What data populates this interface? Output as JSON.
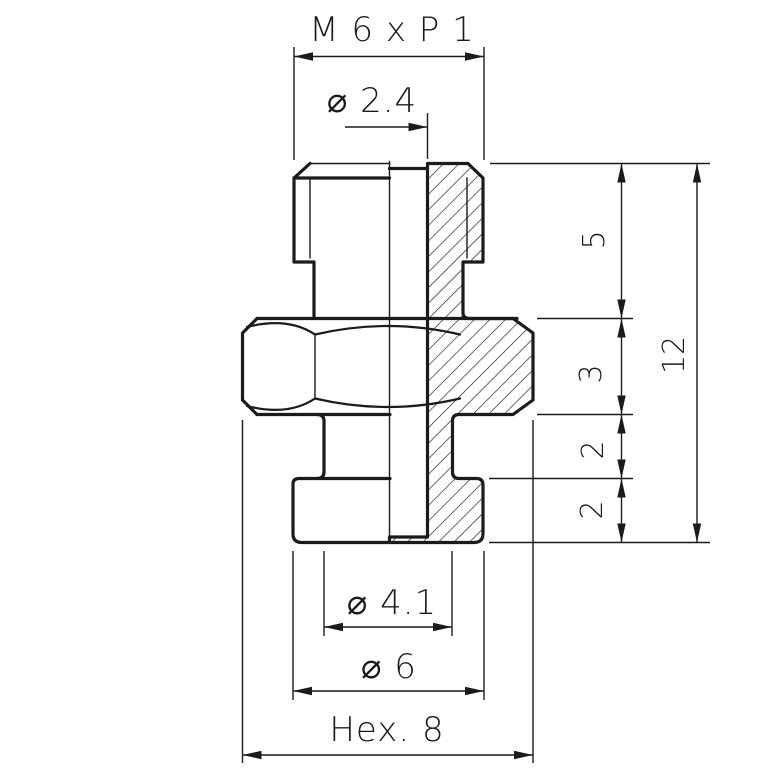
{
  "page": {
    "background": "#ffffff",
    "ink": "#1b1b1b"
  },
  "labels": {
    "thread_spec": "M 6 x P 1",
    "hole_diameter": "⌀ 2.4",
    "thread_length": "5",
    "hex_thickness": "3",
    "neck_length": "2",
    "flange_thickness": "2",
    "overall_length": "12",
    "neck_diameter": "⌀ 4.1",
    "flange_diameter": "⌀ 6",
    "hex_width": "Hex. 8"
  }
}
